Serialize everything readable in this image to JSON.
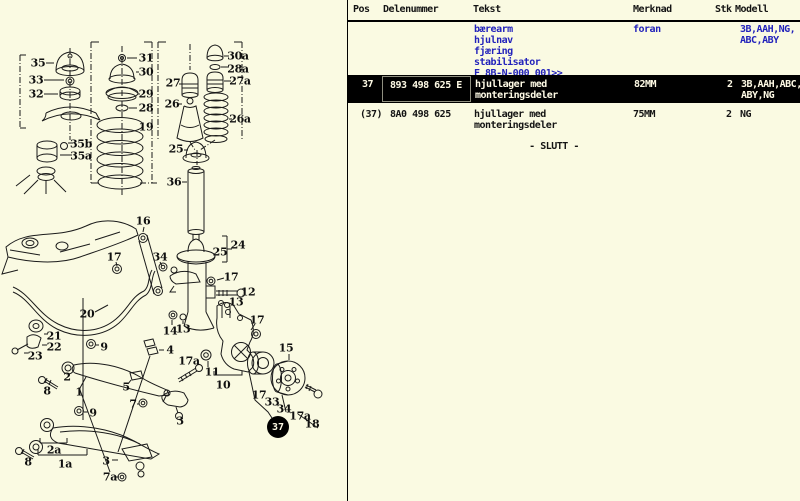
{
  "colors": {
    "page_bg": "#fafae2",
    "accent_blue": "#2222bb",
    "selected_row_bg": "#000000",
    "selected_row_fg": "#fffbe6",
    "line_color": "#1b1b1b"
  },
  "table": {
    "columns": [
      {
        "key": "pos",
        "label": "Pos"
      },
      {
        "key": "delenummer",
        "label": "Delenummer"
      },
      {
        "key": "tekst",
        "label": "Tekst"
      },
      {
        "key": "merknad",
        "label": "Merknad"
      },
      {
        "key": "stk",
        "label": "Stk"
      },
      {
        "key": "modell",
        "label": "Modell"
      }
    ],
    "group": {
      "tekst_lines": [
        "bærearm",
        "hjulnav",
        "fjæring",
        "stabilisator",
        "F 8B-N-000 001>>"
      ],
      "merknad": "foran",
      "modell_lines": [
        "3B,AAH,NG,",
        "ABC,ABY"
      ]
    },
    "rows": [
      {
        "pos": "37",
        "delenummer": "893 498 625 E",
        "tekst_lines": [
          "hjullager med",
          "monteringsdeler"
        ],
        "merknad": "82MM",
        "stk": "2",
        "modell_lines": [
          "3B,AAH,ABC,",
          "ABY,NG"
        ],
        "selected": true
      },
      {
        "pos": "(37)",
        "delenummer": "8A0 498 625",
        "tekst_lines": [
          "hjullager med",
          "monteringsdeler"
        ],
        "merknad": "75MM",
        "stk": "2",
        "modell_lines": [
          "NG"
        ],
        "selected": false
      }
    ],
    "end_marker": "- SLUTT -"
  },
  "diagram": {
    "badge": {
      "text": "37"
    },
    "labels": [
      {
        "text": "35",
        "x": 38,
        "y": 63
      },
      {
        "text": "33",
        "x": 36,
        "y": 80
      },
      {
        "text": "32",
        "x": 36,
        "y": 94
      },
      {
        "text": "31",
        "x": 146,
        "y": 58
      },
      {
        "text": "30",
        "x": 146,
        "y": 72
      },
      {
        "text": "29",
        "x": 146,
        "y": 94
      },
      {
        "text": "28",
        "x": 146,
        "y": 108
      },
      {
        "text": "19",
        "x": 146,
        "y": 127
      },
      {
        "text": "27",
        "x": 173,
        "y": 83
      },
      {
        "text": "26",
        "x": 172,
        "y": 104
      },
      {
        "text": "30a",
        "x": 238,
        "y": 56
      },
      {
        "text": "28a",
        "x": 238,
        "y": 69
      },
      {
        "text": "27a",
        "x": 240,
        "y": 81
      },
      {
        "text": "26a",
        "x": 240,
        "y": 119
      },
      {
        "text": "25",
        "x": 176,
        "y": 149
      },
      {
        "text": "36",
        "x": 174,
        "y": 182
      },
      {
        "text": "35b",
        "x": 81,
        "y": 144
      },
      {
        "text": "35a",
        "x": 81,
        "y": 156
      },
      {
        "text": "16",
        "x": 143,
        "y": 221
      },
      {
        "text": "24",
        "x": 238,
        "y": 245
      },
      {
        "text": "25",
        "x": 220,
        "y": 252
      },
      {
        "text": "17",
        "x": 114,
        "y": 257
      },
      {
        "text": "34",
        "x": 160,
        "y": 257
      },
      {
        "text": "17",
        "x": 231,
        "y": 277
      },
      {
        "text": "12",
        "x": 248,
        "y": 292
      },
      {
        "text": "13",
        "x": 236,
        "y": 302
      },
      {
        "text": "20",
        "x": 87,
        "y": 314
      },
      {
        "text": "14",
        "x": 170,
        "y": 331
      },
      {
        "text": "13",
        "x": 183,
        "y": 329
      },
      {
        "text": "21",
        "x": 54,
        "y": 336
      },
      {
        "text": "22",
        "x": 54,
        "y": 347
      },
      {
        "text": "23",
        "x": 35,
        "y": 356
      },
      {
        "text": "9",
        "x": 104,
        "y": 347
      },
      {
        "text": "4",
        "x": 170,
        "y": 350
      },
      {
        "text": "17",
        "x": 257,
        "y": 320
      },
      {
        "text": "15",
        "x": 286,
        "y": 348
      },
      {
        "text": "17a",
        "x": 189,
        "y": 361
      },
      {
        "text": "11",
        "x": 212,
        "y": 372
      },
      {
        "text": "10",
        "x": 223,
        "y": 385
      },
      {
        "text": "2",
        "x": 67,
        "y": 377
      },
      {
        "text": "8",
        "x": 47,
        "y": 391
      },
      {
        "text": "1",
        "x": 79,
        "y": 392
      },
      {
        "text": "5",
        "x": 126,
        "y": 387
      },
      {
        "text": "7",
        "x": 133,
        "y": 404
      },
      {
        "text": "9",
        "x": 93,
        "y": 413
      },
      {
        "text": "3",
        "x": 180,
        "y": 421
      },
      {
        "text": "17",
        "x": 259,
        "y": 395
      },
      {
        "text": "33",
        "x": 272,
        "y": 402
      },
      {
        "text": "34",
        "x": 284,
        "y": 409
      },
      {
        "text": "17a",
        "x": 300,
        "y": 416
      },
      {
        "text": "18",
        "x": 312,
        "y": 424
      },
      {
        "text": "2a",
        "x": 54,
        "y": 450
      },
      {
        "text": "8",
        "x": 28,
        "y": 462
      },
      {
        "text": "1a",
        "x": 65,
        "y": 464
      },
      {
        "text": "3",
        "x": 106,
        "y": 461
      },
      {
        "text": "7a",
        "x": 110,
        "y": 477
      }
    ]
  }
}
